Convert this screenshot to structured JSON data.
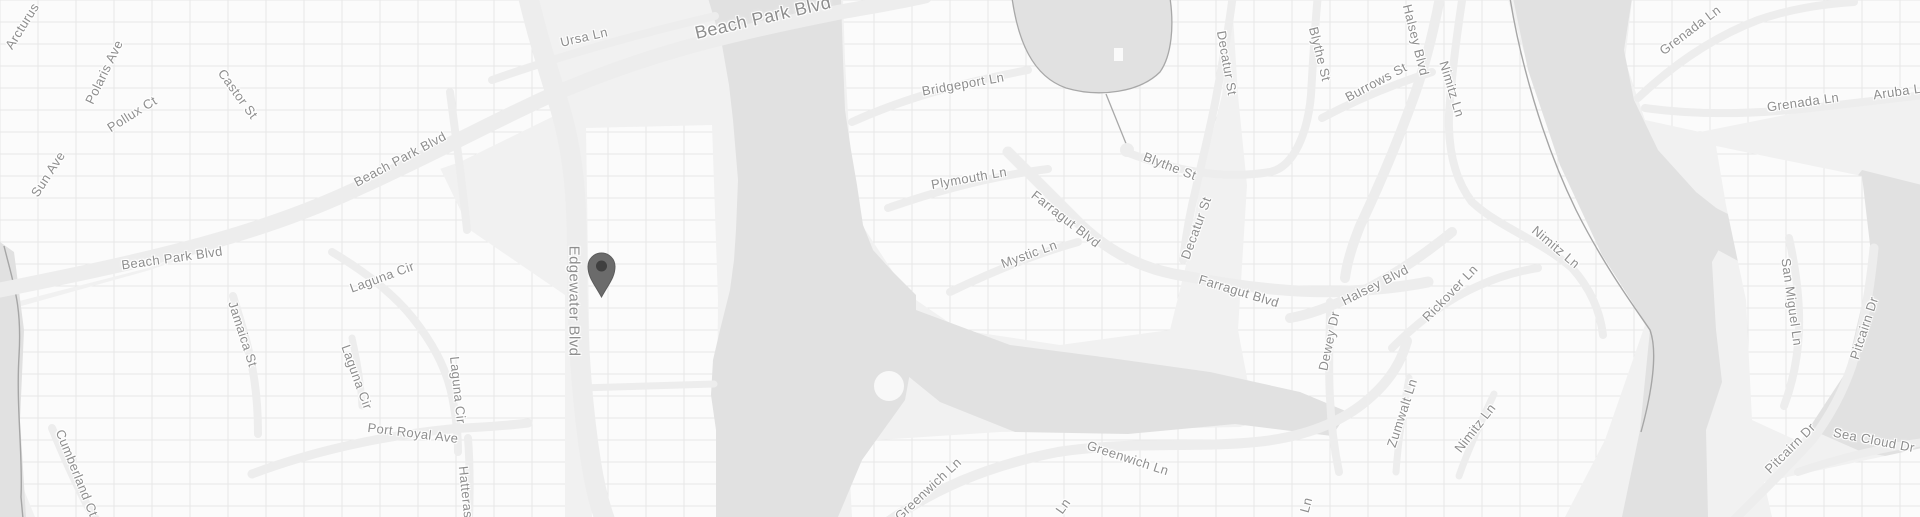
{
  "map": {
    "style": "grayscale-road-map",
    "colors": {
      "land": "#f1f1f1",
      "parcel_fill": "#fbfbfb",
      "parcel_line": "#e7e7e7",
      "road": "#ededed",
      "water": "#e1e1e1",
      "water_outline": "#a8a8a8",
      "seawall": "#a6a6a6",
      "label_text": "#8e8e8e",
      "pin_body": "#6b6b6b",
      "pin_dot": "#3f3f3f"
    },
    "pin": {
      "x": 601.5,
      "y": 266,
      "name": "location-marker"
    },
    "street_labels": [
      {
        "text": "Arcturus",
        "x": 22,
        "y": 26,
        "rot": -58,
        "size": 13
      },
      {
        "text": "Polaris Ave",
        "x": 104,
        "y": 72,
        "rot": -64,
        "size": 13
      },
      {
        "text": "Pollux Ct",
        "x": 132,
        "y": 114,
        "rot": -32,
        "size": 13
      },
      {
        "text": "Castor St",
        "x": 238,
        "y": 94,
        "rot": 54,
        "size": 13
      },
      {
        "text": "Sun Ave",
        "x": 48,
        "y": 174,
        "rot": -57,
        "size": 13
      },
      {
        "text": "Beach Park Blvd",
        "x": 400,
        "y": 159,
        "rot": -28,
        "size": 13
      },
      {
        "text": "Beach Park Blvd",
        "x": 172,
        "y": 258,
        "rot": -8,
        "size": 13
      },
      {
        "text": "Beach Park Blvd",
        "x": 763,
        "y": 18,
        "rot": -13,
        "size": 18
      },
      {
        "text": "Ursa Ln",
        "x": 584,
        "y": 37,
        "rot": -13,
        "size": 13
      },
      {
        "text": "Edgewater Blvd",
        "x": 574,
        "y": 301,
        "rot": 90,
        "size": 15
      },
      {
        "text": "Jamaica St",
        "x": 243,
        "y": 334,
        "rot": 72,
        "size": 13
      },
      {
        "text": "Laguna Cir",
        "x": 382,
        "y": 277,
        "rot": -20,
        "size": 13
      },
      {
        "text": "Laguna Cir",
        "x": 357,
        "y": 377,
        "rot": 70,
        "size": 13
      },
      {
        "text": "Laguna Cir",
        "x": 458,
        "y": 390,
        "rot": 84,
        "size": 13
      },
      {
        "text": "Port Royal Ave",
        "x": 413,
        "y": 433,
        "rot": 7,
        "size": 13
      },
      {
        "text": "Cumberland Ct",
        "x": 77,
        "y": 473,
        "rot": 68,
        "size": 13
      },
      {
        "text": "Hatteras",
        "x": 466,
        "y": 492,
        "rot": 84,
        "size": 13
      },
      {
        "text": "Bridgeport Ln",
        "x": 963,
        "y": 84,
        "rot": -10,
        "size": 13
      },
      {
        "text": "Plymouth Ln",
        "x": 969,
        "y": 178,
        "rot": -10,
        "size": 13
      },
      {
        "text": "Blythe St",
        "x": 1170,
        "y": 166,
        "rot": 21,
        "size": 13
      },
      {
        "text": "Decatur St",
        "x": 1227,
        "y": 63,
        "rot": 80,
        "size": 13
      },
      {
        "text": "Decatur St",
        "x": 1196,
        "y": 228,
        "rot": -70,
        "size": 13
      },
      {
        "text": "Mystic Ln",
        "x": 1029,
        "y": 254,
        "rot": -20,
        "size": 13
      },
      {
        "text": "Farragut Blvd",
        "x": 1066,
        "y": 219,
        "rot": 38,
        "size": 13
      },
      {
        "text": "Farragut Blvd",
        "x": 1239,
        "y": 291,
        "rot": 17,
        "size": 13
      },
      {
        "text": "Blythe St",
        "x": 1320,
        "y": 54,
        "rot": 76,
        "size": 13
      },
      {
        "text": "Burrows St",
        "x": 1376,
        "y": 82,
        "rot": -28,
        "size": 13
      },
      {
        "text": "Halsey Blvd",
        "x": 1416,
        "y": 40,
        "rot": 76,
        "size": 13
      },
      {
        "text": "Nimitz Ln",
        "x": 1452,
        "y": 89,
        "rot": 73,
        "size": 13
      },
      {
        "text": "Halsey Blvd",
        "x": 1375,
        "y": 285,
        "rot": -27,
        "size": 13
      },
      {
        "text": "Rickover Ln",
        "x": 1450,
        "y": 293,
        "rot": -46,
        "size": 13
      },
      {
        "text": "Nimitz Ln",
        "x": 1556,
        "y": 247,
        "rot": 40,
        "size": 13
      },
      {
        "text": "Dewey Dr",
        "x": 1329,
        "y": 341,
        "rot": -78,
        "size": 13
      },
      {
        "text": "Zumwalt Ln",
        "x": 1402,
        "y": 413,
        "rot": -72,
        "size": 13
      },
      {
        "text": "Nimitz Ln",
        "x": 1475,
        "y": 428,
        "rot": -52,
        "size": 13
      },
      {
        "text": "Grenada Ln",
        "x": 1690,
        "y": 30,
        "rot": -37,
        "size": 13
      },
      {
        "text": "Grenada Ln",
        "x": 1803,
        "y": 102,
        "rot": -8,
        "size": 13
      },
      {
        "text": "Aruba Ln",
        "x": 1901,
        "y": 91,
        "rot": -8,
        "size": 13
      },
      {
        "text": "San Miguel Ln",
        "x": 1792,
        "y": 302,
        "rot": 82,
        "size": 13
      },
      {
        "text": "Pitcairn Dr",
        "x": 1864,
        "y": 328,
        "rot": -72,
        "size": 13
      },
      {
        "text": "Pitcairn Dr",
        "x": 1790,
        "y": 448,
        "rot": -45,
        "size": 13
      },
      {
        "text": "Sea Cloud Dr",
        "x": 1874,
        "y": 440,
        "rot": 11,
        "size": 13
      },
      {
        "text": "Greenwich Ln",
        "x": 1128,
        "y": 458,
        "rot": 18,
        "size": 13
      },
      {
        "text": "Greenwich Ln",
        "x": 928,
        "y": 489,
        "rot": -43,
        "size": 13
      },
      {
        "text": "Ln",
        "x": 1063,
        "y": 506,
        "rot": -55,
        "size": 13
      },
      {
        "text": "Ln",
        "x": 1306,
        "y": 505,
        "rot": -75,
        "size": 13
      }
    ]
  }
}
